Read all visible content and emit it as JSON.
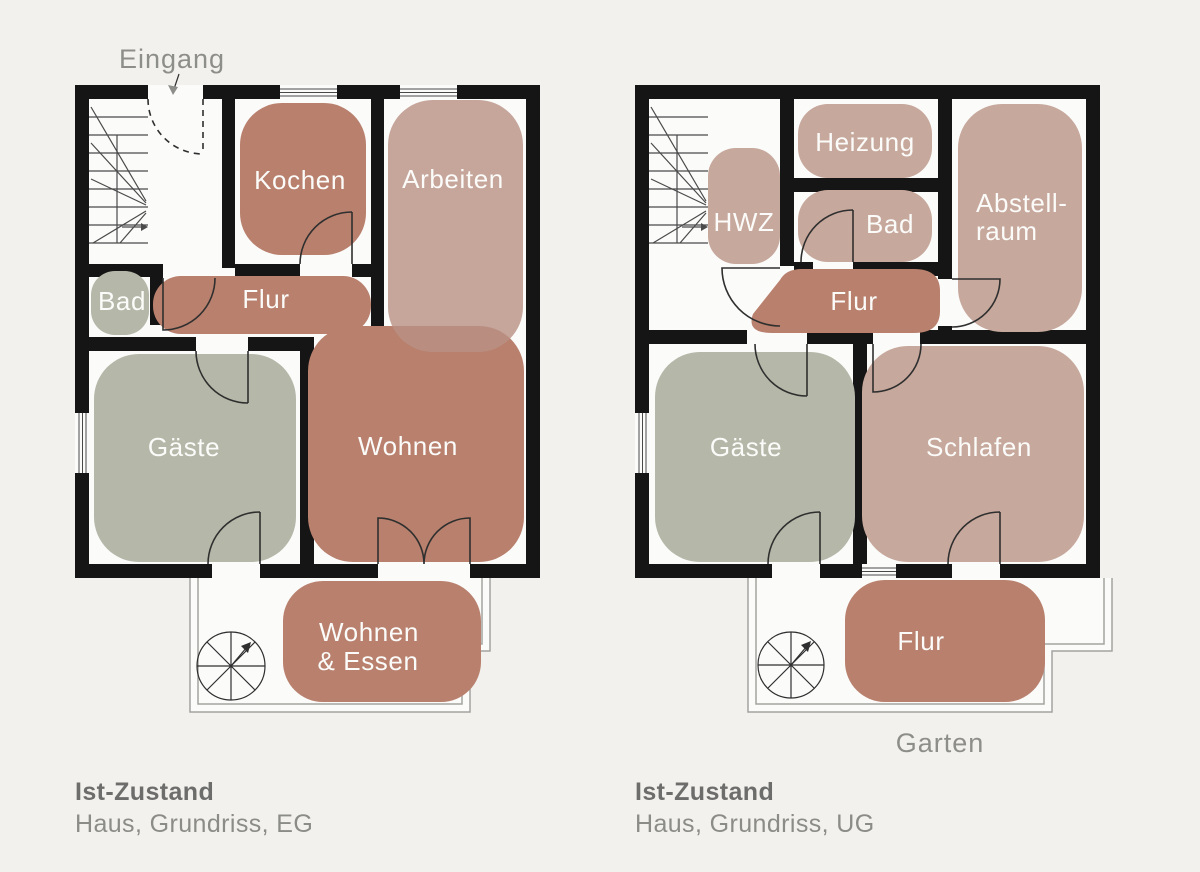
{
  "colors": {
    "bg": "#f2f1ee",
    "floor": "#fbfbfa",
    "wall": "#151515",
    "terracotta": "#b8806d",
    "rose": "#c7a89c",
    "roseBase": "#b99185",
    "sage": "#b5b7a8",
    "label": "#fbfbf9",
    "note": "#8d8d8a",
    "capTitle": "#6d6d6b",
    "capSub": "#8b8b88",
    "line": "#2f2f2f",
    "stair": "#4a4a4a",
    "terrace": "#a3a3a0"
  },
  "plans": {
    "eg": {
      "entrance_label": "Eingang",
      "rooms": {
        "kochen": "Kochen",
        "arbeiten": "Arbeiten",
        "bad": "Bad",
        "flur": "Flur",
        "gaeste": "Gäste",
        "wohnen": "Wohnen",
        "wohnen_essen_1": "Wohnen",
        "wohnen_essen_2": "& Essen"
      },
      "caption_title": "Ist-Zustand",
      "caption_subtitle": "Haus, Grundriss, EG"
    },
    "ug": {
      "garden_label": "Garten",
      "rooms": {
        "heizung": "Heizung",
        "hwz": "HWZ",
        "bad": "Bad",
        "abstellraum_1": "Abstell-",
        "abstellraum_2": "raum",
        "flur": "Flur",
        "gaeste": "Gäste",
        "schlafen": "Schlafen",
        "flur_terrasse": "Flur"
      },
      "caption_title": "Ist-Zustand",
      "caption_subtitle": "Haus, Grundriss, UG"
    }
  }
}
